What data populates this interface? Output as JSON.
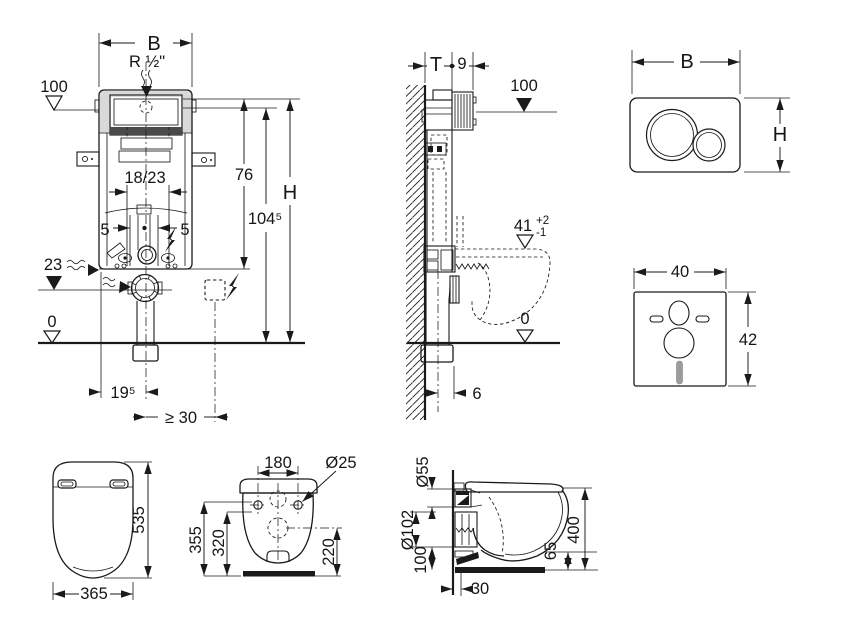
{
  "colors": {
    "line": "#1a1a1a",
    "background": "#ffffff",
    "shading": "#d9d9d9",
    "mat_slot": "#9c9c9c"
  },
  "drawing": {
    "frame_front": {
      "width_label": "B",
      "inlet_label": "R ½\"",
      "level_100": "100",
      "rail_spacing": "18/23",
      "height_76": "76",
      "height_104_5": "104⁵",
      "total_height": "H",
      "offset_5_left": "5",
      "offset_5_right": "5",
      "level_23": "23",
      "level_0": "0",
      "outlet_offset": "19⁵",
      "min_clearance": "≥ 30"
    },
    "frame_side": {
      "depth_label": "T",
      "front_offset": "9",
      "level_100": "100",
      "pan_height": "41",
      "tol_plus": "+2",
      "tol_minus": "-1",
      "level_0": "0",
      "outlet_offset": "6"
    },
    "flush_plate": {
      "width_label": "B",
      "height_label": "H"
    },
    "sound_mat": {
      "width": "40",
      "height": "42"
    },
    "pan_top": {
      "depth": "535",
      "width": "365"
    },
    "pan_rear": {
      "hole_spacing": "180",
      "hole_dia": "Ø25",
      "height_overall": "355",
      "height_inner": "320",
      "outlet_height": "220"
    },
    "pan_side": {
      "flush_pipe_dia": "Ø55",
      "outlet_pipe_dia": "Ø102",
      "outlet_axis_height": "100",
      "wall_gap": "30",
      "rim_clearance": "65",
      "height_overall": "400"
    }
  }
}
